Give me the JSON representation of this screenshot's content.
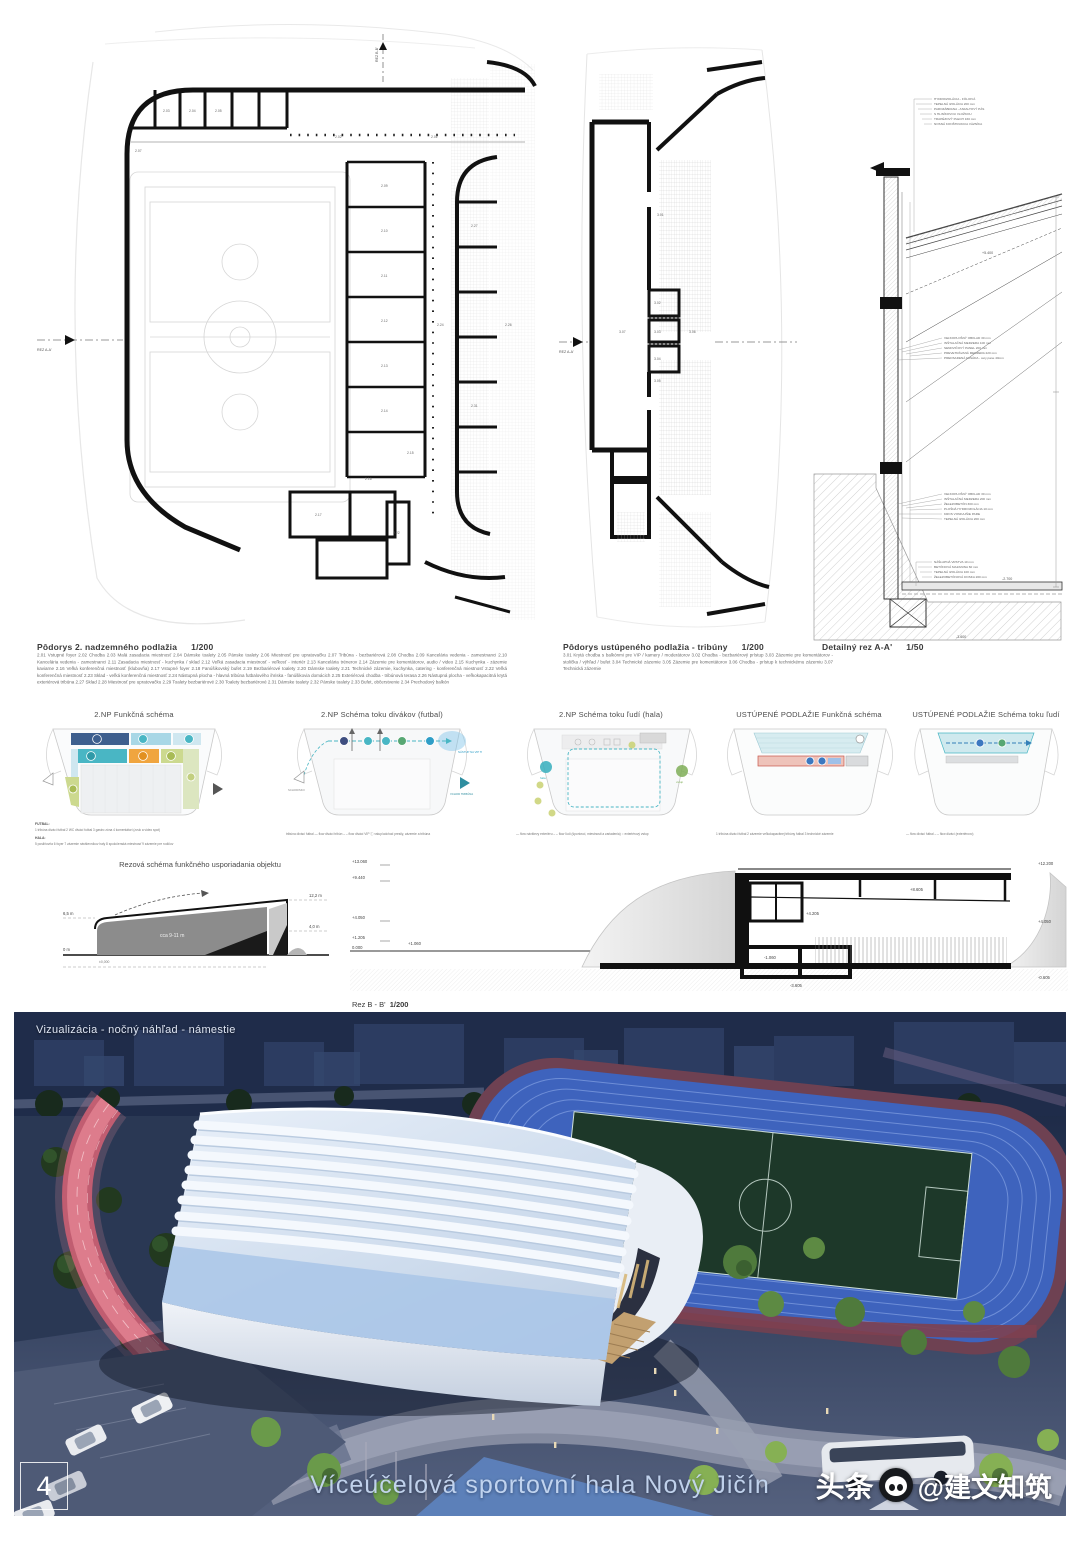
{
  "footer": {
    "page_number": "4",
    "board_title": "Víceúčelová sportovní hala Nový Jičín",
    "watermark_brand": "头条",
    "watermark_handle": "@建文知筑"
  },
  "visualization": {
    "caption": "Vizualizácia - nočný náhľad - námestie"
  },
  "plan_2np": {
    "title": "Pôdorys 2. nadzemného podlažia",
    "scale": "1/200",
    "section_marker": "REZ A-A'",
    "top_marker": "REZ B-B'",
    "rooms": [
      "2.01",
      "2.02",
      "2.03",
      "2.04",
      "2.05",
      "2.07",
      "2.09",
      "2.10",
      "2.11",
      "2.12",
      "2.13",
      "2.14",
      "2.15",
      "2.16",
      "2.17",
      "2.22",
      "2.24",
      "2.26",
      "2.27",
      "2.31"
    ],
    "legend": "2.01 Vstupné foyer   2.02 Chodba   2.03 Malá zasadacia miestnosť   2.04 Dámske toalety   2.05 Pánske toalety   2.06 Miestnosť pre upratovačku   2.07 Tribúna - bezbariérová   2.08 Chodba   2.09 Kancelária vedenia - zamestnanci   2.10 Kancelária vedenia - zamestnanci   2.11 Zasadacia miestnosť - kuchynka / sklad   2.12 Veľká zasadacia miestnosť - veľkosť - interiér   2.13 Kancelária trénerov   2.14 Zázemie pre komentátorov, audio / video   2.15 Kuchynka - zázemie kaviarne   2.16 Veľká konferenčná miestnosť (klubovňa)   2.17 Vstupné foyer   2.18 Fanúšikovský bufet   2.19 Bezbariérové toalety   2.20 Dámske toalety   2.21 Technické zázemie, kuchynka, catering - konferenčná miestnosť   2.22 Veľká konferenčná miestnosť   2.23 Sklad - veľká konferenčná miestnosť   2.24 Nástupná plocha - hlavná tribúna futbalového ihriska - fanúšikovia domácich   2.25 Exteriérová chodba - tribúnová terasa   2.26 Nástupná plocha - veľkokapacitná krytá exteriérová tribúna   2.27 Sklad   2.28 Miestnosť pre upratovačku   2.29 Toalety bezbariérové   2.30 Toalety bezbariérové   2.31 Dámske toalety   2.32 Pánske toalety   2.33 Bufet, občerstvenie   2.34 Prechodový balkón"
  },
  "plan_tribuny": {
    "title": "Pôdorys ustúpeného podlažia - tribúny",
    "scale": "1/200",
    "section_marker": "REZ A-A'",
    "rooms": [
      "3.01",
      "3.02",
      "3.03",
      "3.04",
      "3.05",
      "3.06",
      "3.07"
    ],
    "legend": "3.01 Krytá chodba s balkónmi pre VIP / kamery / moderátorov   3.02 Chodba - bezbariérový prístup   3.03 Zázemie pre komentátorov - stolička / výhľad / bufet   3.04 Technické zázemie   3.05 Zázemie pre komentátorov   3.06 Chodba - prístup k technickému zázemiu   3.07 Technická zázemie"
  },
  "detail": {
    "title": "Detailný rez A-A'",
    "scale": "1/50",
    "annotations": [
      [
        "HYDROIZOLÁCIA - FÓLIOVÁ",
        "TEPELNÁ IZOLÁCIA 200 mm",
        "PAROZÁBRANA - ASFALTOVÝ PÁS",
        "S HLINÍKOVOU VLOŽKOU",
        "TRAPÉZOVÝ PLECH 160 mm",
        "NOSNÁ KONŠTRUKCIA VÄZNÍKA"
      ],
      [
        "VEĽKOPLOŠNÝ OBKLAD 30 mm",
        "INŠTALAČNÁ MEDZERA 100 mm",
        "SENDVIČOVÝ PANEL 200 mm",
        "PREVETRÁVANÁ MEDZERA 220 mm",
        "PREDSADENÁ FASÁDA - cety pane 40mm"
      ],
      [
        "VEĽKOPLOŠNÝ OBKLAD 30 mm",
        "INŠTALAČNÁ MEDZERA 200 mm",
        "ŽELEZOBETÓN 300 mm",
        "PLOŠNÁ HYDROIZOLÁCIA 10 mm",
        "KROS VONKAJŠIE PARE",
        "TEPELNÁ IZOLÁCIA 200 mm"
      ],
      [
        "NÁŠĽAPNÁ VRSTVA 10 mm",
        "BETÓNOVÁ MAZANINA 60 mm",
        "TEPELNÁ IZOLÁCIA 100 mm",
        "ŽELEZOBETÓNOVÁ DOSKA 200 mm"
      ]
    ],
    "levels": [
      "+5.400",
      "-2.700",
      "-3.600"
    ]
  },
  "schemes": [
    {
      "title": "2.NP Funkčná schéma",
      "legend_futbal_label": "FUTBAL:",
      "legend_futbal": "1 tribúna divácí futbal    2 WC divácí futbal    3 gastro zóna    4 komentátori (zvuk a video spot)",
      "legend_hala_label": "HALA:",
      "legend_hala": "5 posilňovňa    6 foyer    7 zázemie návštevníkov haly    8 spoločenská miestnosť    9 zázemie pre rodičov"
    },
    {
      "title": "2.NP Schéma toku divákov (futbal)",
      "legend": "tribúna divácí futbal     ― flow divácí tribún     – – flow divácí VIP     ⓘ vstup/odchod presily, zázemie a tribúna",
      "note_right": "NÁSTUP NA VIP TRIBÚNU",
      "note_bottom": "VCHOD TRIBÚNA",
      "note_left": "SCHODISKO"
    },
    {
      "title": "2.NP Schéma toku ľudí (hala)",
      "legend": "― flow návštevy exteriéru     – – flow ľudí (športovci, miestnosti a zariadenia)     ○ exteriérový vstup",
      "note_left": "hala",
      "note_right": "vstup"
    },
    {
      "title": "USTÚPENÉ PODLAŽIE  Funkčná schéma",
      "legend": "1 tribúna divácí futbal    2 zázemie veľkokapacitnej tribúny futbal    3 technické zázemie"
    },
    {
      "title": "USTÚPENÉ PODLAŽIE  Schéma toku ľudí",
      "legend": "― flow divácí futbal     – – flow divácí (exteriérovo)"
    }
  ],
  "rez_schema": {
    "title": "Rezová schéma funkčného usporiadania objektu",
    "labels": {
      "left_top": "6,5 m",
      "left_bottom": "0 m",
      "right_top": "12,2 m",
      "right_mid": "4,0 m",
      "inner": "cca 9-11 m",
      "base": "±0,000"
    }
  },
  "rez_bb": {
    "title": "Rez B - B'",
    "scale": "1/200",
    "levels_left": [
      "+13.060",
      "+9.440",
      "+4.050",
      "+1.205",
      "0.000"
    ],
    "level_mid": "+1.060",
    "levels_right": [
      "+12.200",
      "+4.050",
      "-0.605"
    ],
    "levels_inner": [
      "+8.605",
      "+4.205",
      "-1.060",
      "-3.605"
    ]
  },
  "colors": {
    "accent_teal": "#49b6c4",
    "accent_blue": "#3e5f8e",
    "accent_orange": "#f0a53f",
    "accent_green": "#ccd98f",
    "accent_salmon": "#eec3ba",
    "night_blue": "#1b2a47",
    "track_blue": "#3e63bd",
    "path_pink": "#c75f72"
  }
}
